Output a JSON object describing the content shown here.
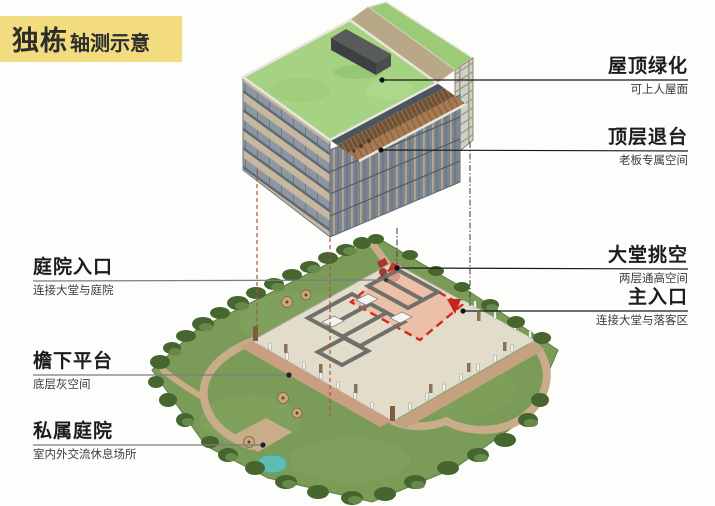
{
  "title": {
    "main": "独栋",
    "sub": "轴测示意"
  },
  "labels": {
    "right": [
      {
        "id": "roof-greening",
        "heading": "屋顶绿化",
        "subtitle": "可上人屋面"
      },
      {
        "id": "top-setback",
        "heading": "顶层退台",
        "subtitle": "老板专属空间"
      },
      {
        "id": "lobby-void",
        "heading": "大堂挑空",
        "subtitle": "两层通高空间"
      },
      {
        "id": "main-entrance",
        "heading": "主入口",
        "subtitle": "连接大堂与落客区"
      }
    ],
    "left": [
      {
        "id": "courtyard-entrance",
        "heading": "庭院入口",
        "subtitle": "连接大堂与庭院"
      },
      {
        "id": "eave-platform",
        "heading": "檐下平台",
        "subtitle": "底层灰空间"
      },
      {
        "id": "private-courtyard",
        "heading": "私属庭院",
        "subtitle": "室内外交流休息场所"
      }
    ]
  },
  "colors": {
    "title_bg": "#f2dc7f",
    "leader_dark": "#1a1a1a",
    "leader_gray": "#7d7d7d",
    "roof_green": "#a6d283",
    "grass_green": "#7b9c58",
    "lobby_pink": "#ecbda7",
    "dash_red": "#d7281b",
    "marker_red": "#c5261b",
    "pond_teal": "#5fbeb2",
    "deck_wood": "#a87a52",
    "facade_beige": "#c6b79e",
    "facade_glass": "#8d97a2"
  }
}
